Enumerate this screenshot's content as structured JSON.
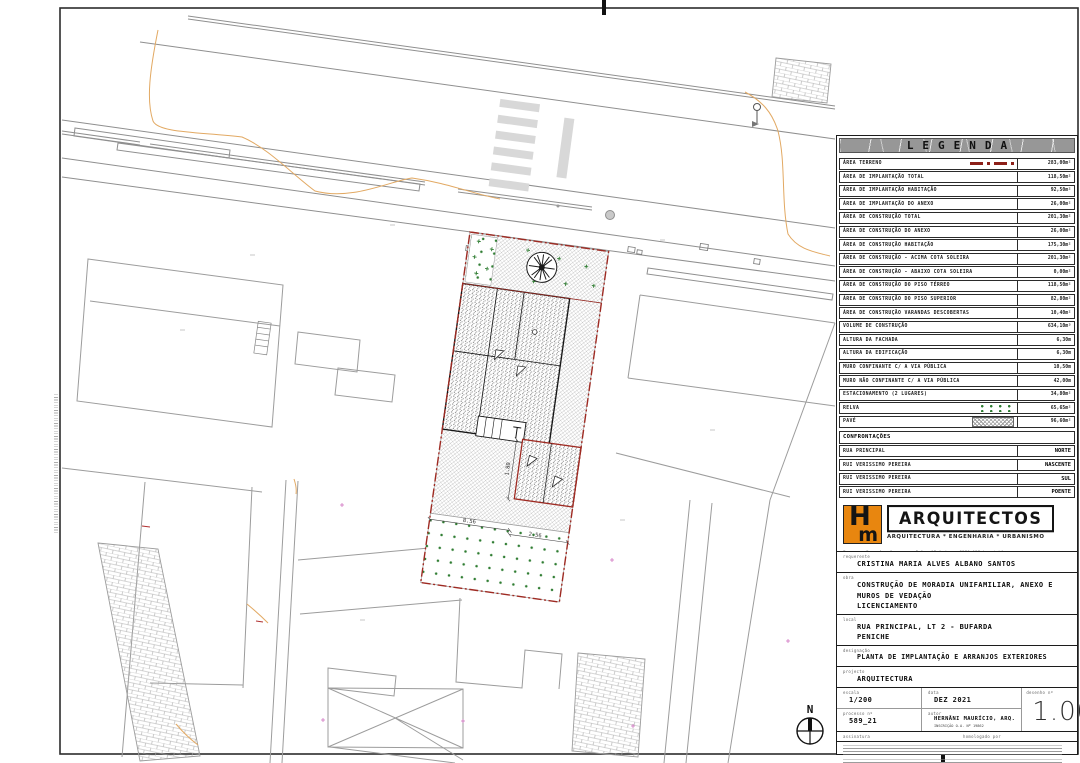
{
  "legend": {
    "title": "LEGENDA",
    "rows": [
      {
        "label": "ÁREA TERRENO",
        "value": "283,00m²",
        "icon": "terreno"
      },
      {
        "label": "ÁREA DE IMPLANTAÇÃO TOTAL",
        "value": "118,50m²"
      },
      {
        "label": "ÁREA DE IMPLANTAÇÃO HABITAÇÃO",
        "value": "92,50m²"
      },
      {
        "label": "ÁREA DE IMPLANTAÇÃO DO ANEXO",
        "value": "26,00m²"
      },
      {
        "label": "ÁREA DE CONSTRUÇÃO TOTAL",
        "value": "201,30m²"
      },
      {
        "label": "ÁREA DE CONSTRUÇÃO DO ANEXO",
        "value": "26,00m²"
      },
      {
        "label": "ÁREA DE CONSTRUÇÃO HABITAÇÃO",
        "value": "175,30m²"
      },
      {
        "label": "ÁREA DE CONSTRUÇÃO - ACIMA COTA SOLEIRA",
        "value": "201,30m²"
      },
      {
        "label": "ÁREA DE CONSTRUÇÃO - ABAIXO COTA SOLEIRA",
        "value": "0,00m²"
      },
      {
        "label": "ÁREA DE CONSTRUÇÃO DO PISO TÉRREO",
        "value": "118,50m²"
      },
      {
        "label": "ÁREA DE CONSTRUÇÃO DO PISO SUPERIOR",
        "value": "82,80m²"
      },
      {
        "label": "ÁREA DE CONSTRUÇÃO VARANDAS DESCOBERTAS",
        "value": "10,40m²"
      },
      {
        "label": "VOLUME DE CONSTRUÇÃO",
        "value": "634,10m³"
      },
      {
        "label": "ALTURA DA FACHADA",
        "value": "6,30m"
      },
      {
        "label": "ALTURA DA EDIFICAÇÃO",
        "value": "6,30m"
      },
      {
        "label": "MURO CONFINANTE C/ A VIA PÚBLICA",
        "value": "10,50m"
      },
      {
        "label": "MURO NÃO CONFINANTE C/ A VIA PÚBLICA",
        "value": "42,00m"
      },
      {
        "label": "ESTACIONAMENTO (2 LUGARES)",
        "value": "34,80m²"
      },
      {
        "label": "RELVA",
        "value": "65,65m²",
        "icon": "relva"
      },
      {
        "label": "PAVÉ",
        "value": "96,60m²",
        "icon": "pave"
      }
    ]
  },
  "confrontacoes": {
    "title": "CONFRONTAÇÕES",
    "rows": [
      {
        "label": "RUA PRINCIPAL",
        "value": "NORTE"
      },
      {
        "label": "RUI VERISSIMO PEREIRA",
        "value": "NASCENTE"
      },
      {
        "label": "RUI VERISSIMO PEREIRA",
        "value": "SUL"
      },
      {
        "label": "RUI VERISSIMO PEREIRA",
        "value": "POENTE"
      }
    ]
  },
  "titleblock": {
    "logo": {
      "monogram_top": "H",
      "monogram_bottom": "m",
      "name": "ARQUITECTOS",
      "tagline": "ARQUITECTURA * ENGENHARIA * URBANISMO",
      "address_line1": "Travessa Dra. Ana Jorge + n.º 1 + 1º Andar + 2530-158 Lourinhã",
      "address_line2": "261 469 481 + 917 567 461 + www.hmarquitectos.pt + mail@hmarquitectos.pt"
    },
    "fields": {
      "requerente_label": "requerente",
      "requerente": "CRISTINA MARIA ALVES ALBANO SANTOS",
      "obra_label": "obra",
      "obra_line1": "CONSTRUÇÃO DE MORADIA UNIFAMILIAR, ANEXO E",
      "obra_line2": "MUROS DE VEDAÇÃO",
      "obra_line3": "LICENCIAMENTO",
      "local_label": "local",
      "local_line1": "RUA PRINCIPAL, LT 2 - BUFARDA",
      "local_line2": "PENICHE",
      "designacao_label": "designação",
      "designacao": "PLANTA DE IMPLANTAÇÃO E ARRANJOS EXTERIORES",
      "projecto_label": "projecto",
      "projecto": "ARQUITECTURA",
      "escala_label": "escala",
      "escala": "1/200",
      "data_label": "data",
      "data": "DEZ 2021",
      "desenho_label": "desenho nº",
      "desenho": "1.00",
      "processo_label": "processo nº",
      "processo": "589_21",
      "autor_label": "autor",
      "autor": "HERNÂNI MAURÍCIO, ARQ.",
      "autor_sub": "INSCRIÇÃO O.A. Nº 19862",
      "assinatura_label": "assinatura",
      "homologado_label": "homologado por"
    }
  },
  "plan": {
    "north_label": "N",
    "dimensions": {
      "d1": "8.56",
      "d2": "2.56",
      "d3": "1.80"
    },
    "colors": {
      "boundary_red": "#9e2a22",
      "grass_green": "#2f7d32",
      "contour_orange": "#e2a963",
      "logo_orange": "#e8860f",
      "road_gray": "#8f8f8f"
    }
  }
}
